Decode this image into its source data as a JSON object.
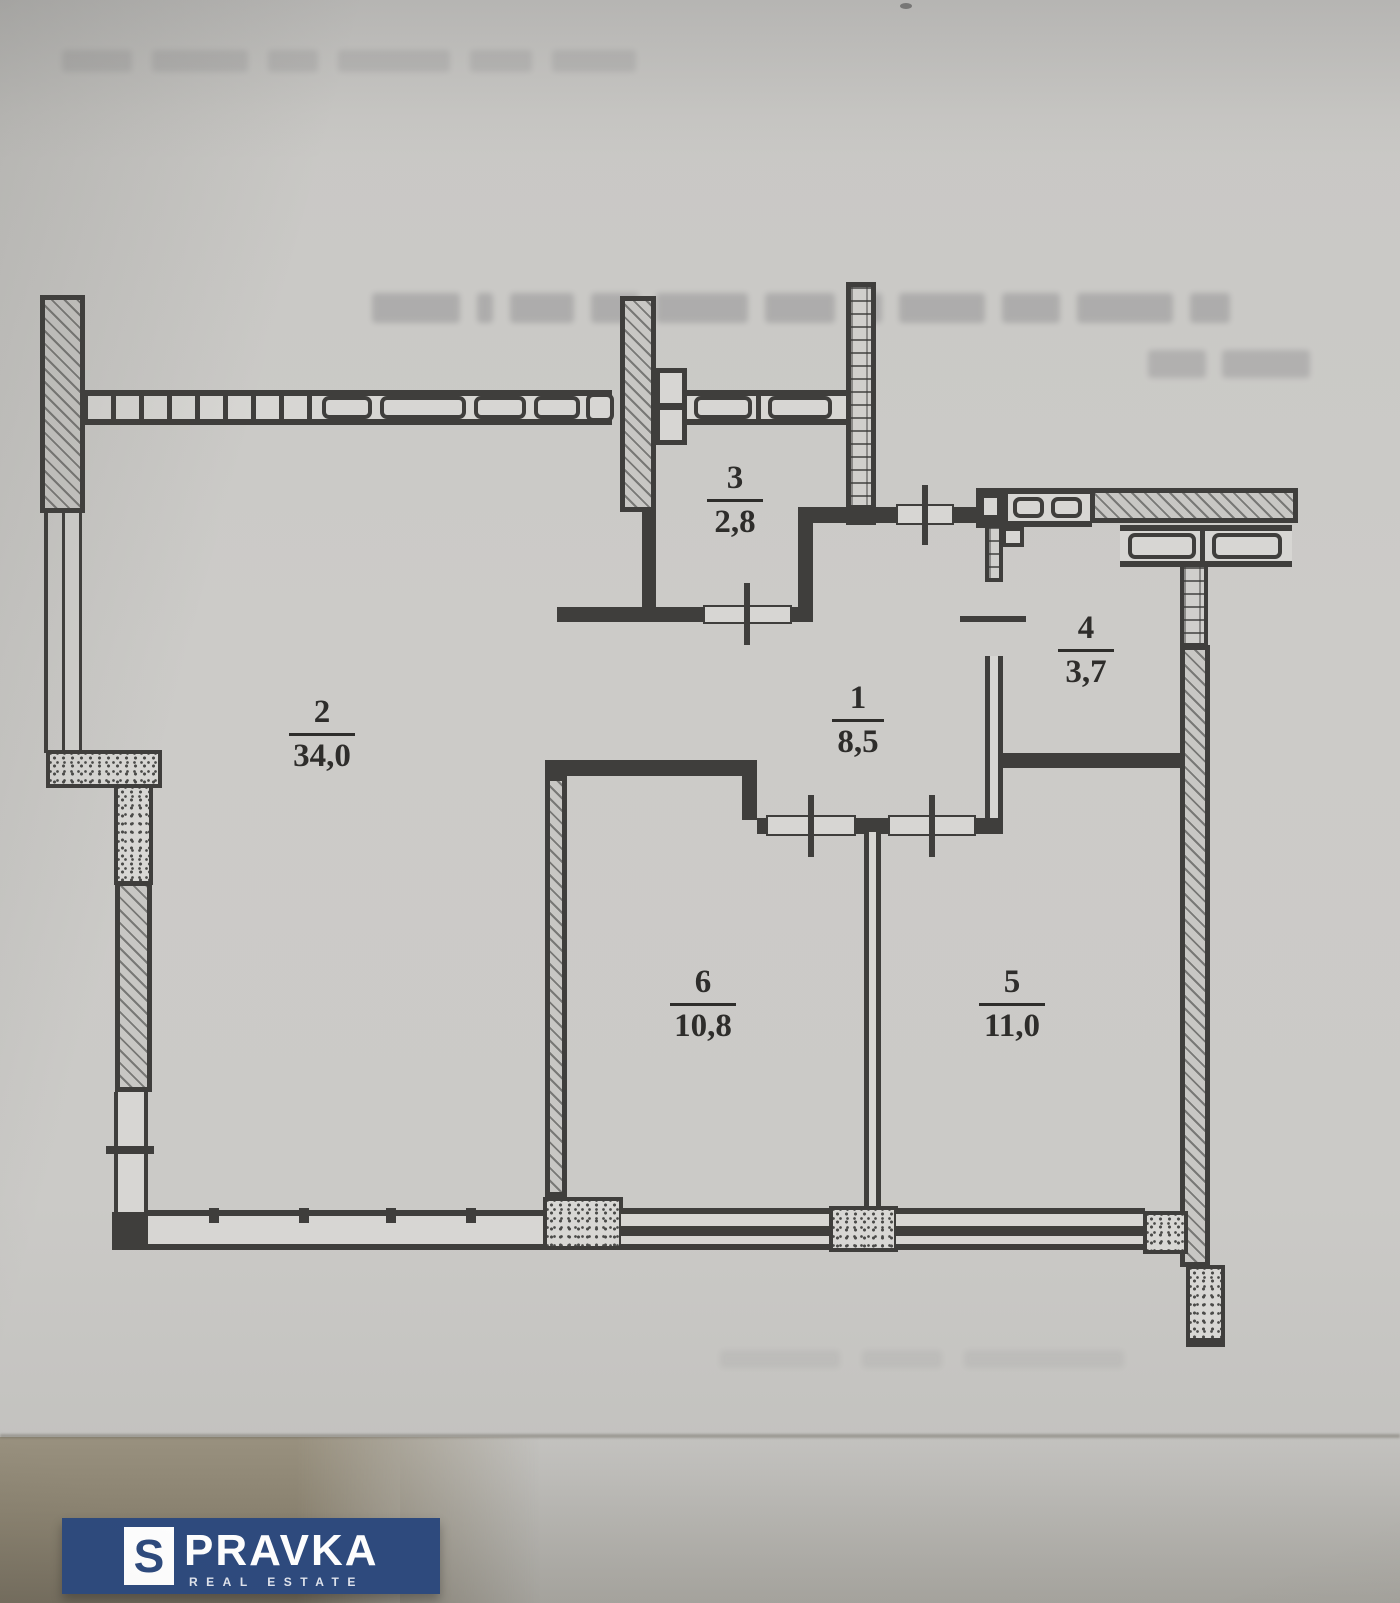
{
  "rooms": [
    {
      "number": "1",
      "area": "8,5"
    },
    {
      "number": "2",
      "area": "34,0"
    },
    {
      "number": "3",
      "area": "2,8"
    },
    {
      "number": "4",
      "area": "3,7"
    },
    {
      "number": "5",
      "area": "11,0"
    },
    {
      "number": "6",
      "area": "10,8"
    }
  ],
  "watermark": {
    "logo_letter": "S",
    "brand": "PRAVKA",
    "tagline": "REAL ESTATE",
    "banner_color": "#2e4a7d",
    "letter_color": "#2e4a7d"
  },
  "colors": {
    "paper": "#c9c8c5",
    "ink": "#3f3e3c"
  }
}
